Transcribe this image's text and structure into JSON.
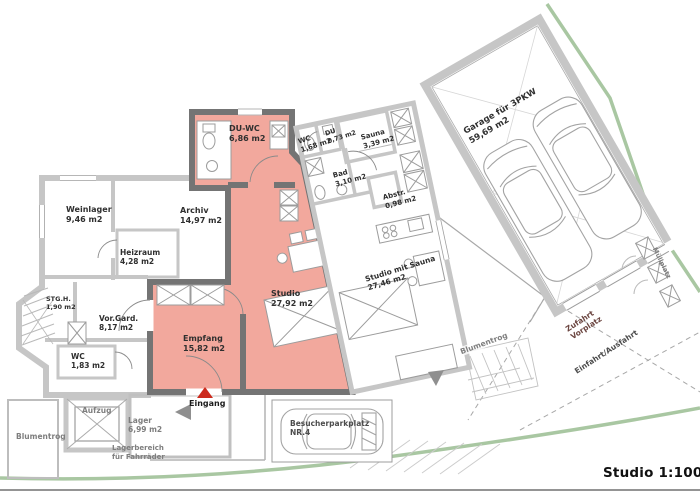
{
  "meta": {
    "scale_label": "Studio 1:100"
  },
  "colors": {
    "room_fill": "#f2a89d",
    "wall_dark": "#747474",
    "wall_light": "#c6c6c6",
    "thin_line": "#9c9c9c",
    "site_boundary_green": "#a9c7a2",
    "accent_red": "#cc2a1d",
    "label_dark": "#2f2f2f",
    "label_gray": "#7e7e7e"
  },
  "rooms": [
    {
      "id": "du-wc",
      "name": "DU-WC",
      "area": "6,86 m2"
    },
    {
      "id": "wc-wing",
      "name": "WC",
      "area": "1,68 m2"
    },
    {
      "id": "du",
      "name": "DU",
      "area": "0,73 m2"
    },
    {
      "id": "sauna",
      "name": "Sauna",
      "area": "3,39 m2"
    },
    {
      "id": "bad",
      "name": "Bad",
      "area": "3,10 m2"
    },
    {
      "id": "abstellraum",
      "name": "Abstr.",
      "area": "0,98 m2"
    },
    {
      "id": "garage",
      "name": "Garage für 3PKW",
      "area": "59,69 m2"
    },
    {
      "id": "weinlager",
      "name": "Weinlager",
      "area": "9,46 m2"
    },
    {
      "id": "archiv",
      "name": "Archiv",
      "area": "14,97 m2"
    },
    {
      "id": "heizraum",
      "name": "Heizraum",
      "area": "4,28 m2"
    },
    {
      "id": "stgh",
      "name": "STG.H.",
      "area": "1,90 m2"
    },
    {
      "id": "vorgard",
      "name": "Vor.Gard.",
      "area": "8,17 m2"
    },
    {
      "id": "wc-left",
      "name": "WC",
      "area": "1,83 m2"
    },
    {
      "id": "empfang",
      "name": "Empfang",
      "area": "15,82 m2"
    },
    {
      "id": "studio",
      "name": "Studio",
      "area": "27,92 m2"
    },
    {
      "id": "studio-sauna",
      "name": "Studio mit Sauna",
      "area": "27,46 m2"
    },
    {
      "id": "lager",
      "name": "Lager",
      "area": "6,99 m2"
    }
  ],
  "annotations": {
    "eingang": "Eingang",
    "aufzug": "Aufzug",
    "lagerbereich_line1": "Lagerbereich",
    "lagerbereich_line2": "für Fahrräder",
    "blumentrog_left": "Blumentrog",
    "blumentrog_right": "Blumentrog",
    "besucher_line1": "Besucherparkplatz",
    "besucher_line2": "NR.4",
    "zufahrt_line1": "Zufahrt",
    "zufahrt_line2": "Vorplatz",
    "einfahrt": "Einfahrt/Ausfahrt",
    "muellplatz": "Müllplatz"
  }
}
